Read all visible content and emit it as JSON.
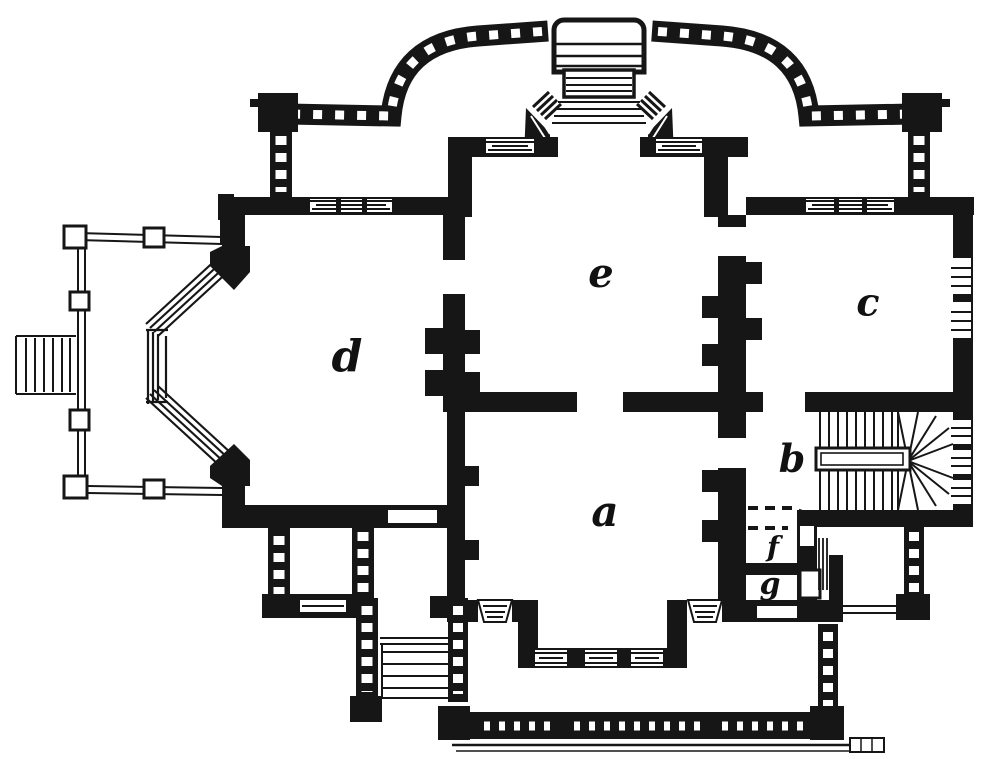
{
  "figure": {
    "type": "architectural floor plan",
    "ink_color": "#161616",
    "paper_color": "#ffffff"
  },
  "rooms": [
    {
      "id": "a",
      "label": "a"
    },
    {
      "id": "b",
      "label": "b"
    },
    {
      "id": "c",
      "label": "c"
    },
    {
      "id": "d",
      "label": "d"
    },
    {
      "id": "e",
      "label": "e"
    },
    {
      "id": "f",
      "label": "f"
    },
    {
      "id": "g",
      "label": "g"
    }
  ]
}
